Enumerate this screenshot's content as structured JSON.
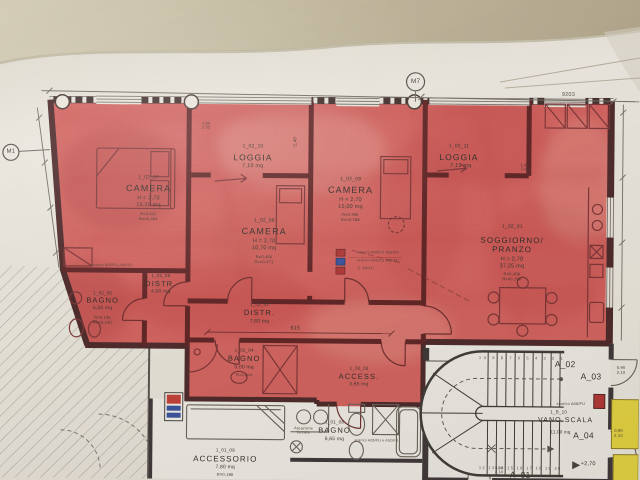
{
  "markers": {
    "m1": "M1",
    "m7": "M7"
  },
  "dims": {
    "total": "9203",
    "hall": "615",
    "level": "+2,70",
    "door_tag": "0,90\n2,10",
    "window_tag": "1,45\n2,00",
    "window_tag2": "1,80\n2,02",
    "loggia_depth": "2,40"
  },
  "stairs": {
    "treads_top": "10 9 8 7 6 5 4 3 2 1",
    "treads_bottom": "12 13 14 15 16 17 18 19 20"
  },
  "units": {
    "a01": "A_01",
    "a02": "A_02",
    "a03": "A_03",
    "a04": "A_04"
  },
  "annotations": {
    "areazione": "Areazione\nforzata",
    "scarico_a": "scarico A05/FU,A06/FU",
    "scarico_b": "scarico A06/FU",
    "scarico_c": "scarico A05/FU e A02/FU",
    "legend": [
      "scarico A05/FU A06/FU",
      "scarico A05/EU A06/EU",
      "F. ARIFU"
    ]
  },
  "rooms": {
    "camera1": {
      "code": "1_02_07",
      "name": "CAMERA",
      "h": "H = 2,70",
      "area": "15,35 mq",
      "r": "R=0,441",
      "rv": "Rv=0,464"
    },
    "loggia1": {
      "code": "1_02_10",
      "name": "LOGGIA",
      "area": "7,10 mq"
    },
    "camera2": {
      "code": "1_02_08",
      "name": "CAMERA",
      "h": "H = 2,70",
      "area": "10,70 mq",
      "r": "R=0,466",
      "rv": "Rv=0,471"
    },
    "camera3": {
      "code": "1_02_09",
      "name": "CAMERA",
      "h": "H = 2,70",
      "area": "15,00 mq",
      "r": "R=0,396",
      "rv": "Rv=0,188"
    },
    "loggia2": {
      "code": "1_02_11",
      "name": "LOGGIA",
      "area": "7,15 mq"
    },
    "soggiorno": {
      "code": "1_02_01",
      "name": "SOGGIORNO/",
      "name2": "PRANZO",
      "h": "H = 2,70",
      "area": "37,25 mq",
      "r": "R=0,459",
      "rv": "Rv=0,196"
    },
    "distr1": {
      "code": "1_02_06",
      "name": "DISTR.",
      "area": "4,00 mq"
    },
    "bagno1": {
      "code": "1_02_05",
      "name": "BAGNO",
      "area": "5,50 mq",
      "r": "R=0,136",
      "rv": "Rv=0,100"
    },
    "distr2": {
      "code": "1_02_02",
      "name": "DISTR.",
      "area": "7,60 mq"
    },
    "bagno2": {
      "code": "1_02_04",
      "name": "BAGNO",
      "area": "5,00 mq",
      "r": "R=0,204"
    },
    "access": {
      "code": "1_02_03",
      "name": "ACCESS.",
      "area": "3,65 mq"
    },
    "bagno3": {
      "code": "1_01_08",
      "name": "BAGNO",
      "area": "6,65 mq"
    },
    "accessorio": {
      "code": "1_01_09",
      "name": "ACCESSORIO",
      "area": "7,80 mq",
      "r": "R=0,186"
    },
    "vano_scala": {
      "code": "1_B_10",
      "name": "VANO SCALA",
      "area": "11,00 mq"
    }
  }
}
